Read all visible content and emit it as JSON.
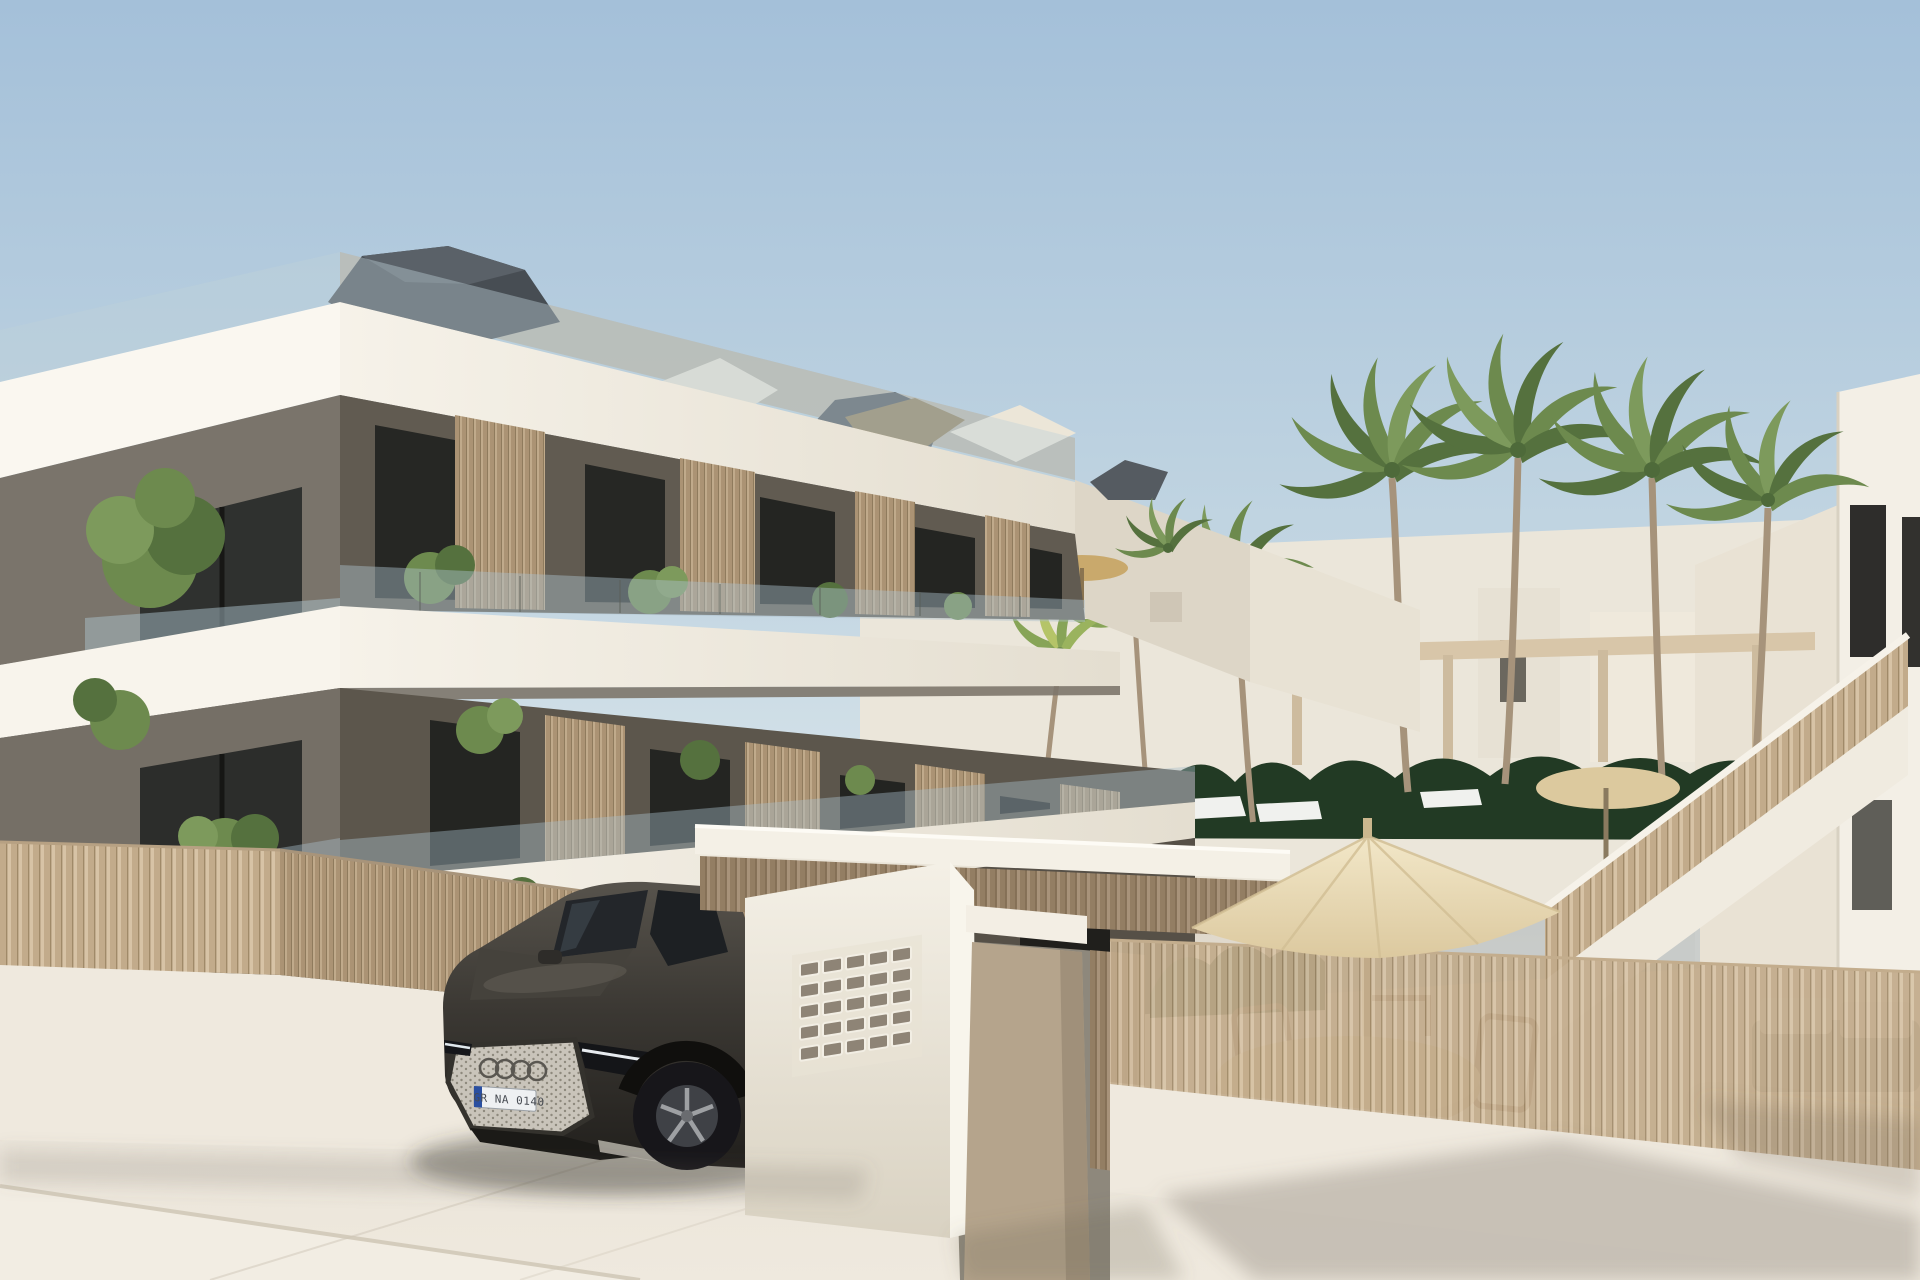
{
  "scene": {
    "title": "New-build apartment complex exterior render",
    "setting": "street-side daytime view with driveway, entrance gate, pool terrace and palm trees",
    "sky": "clear gradient sky"
  },
  "license_plate": {
    "text": "GR NA 0140",
    "eu_band": true
  },
  "palette": {
    "sky_top": "#a4c0d9",
    "sky_horizon": "#eef3f2",
    "fascia_white": "#f8f4ec",
    "fascia_shade": "#e7e1d4",
    "wall_taupe": "#7a746b",
    "wall_taupe_shadow": "#5f594f",
    "window_dark": "#2a2b28",
    "glass_balustrade": "#aabfca",
    "roof_dark": "#474d53",
    "slat_wood": "#c4ae8f",
    "slat_wood_dark": "#a8937a",
    "fence_wood": "#cdb89a",
    "foliage": "#6d8a4e",
    "foliage_dark": "#55713e",
    "hedge_dark": "#223a24",
    "palm_trunk": "#a6937b",
    "pavement": "#e9e3d8",
    "street_light": "#f2ede3",
    "umbrella_cream": "#ecdfbd",
    "pool_water": "#b7c2c6",
    "car_body": "#3b3833",
    "car_glass": "#1d2023",
    "grille_mesh": "#c9c4ba",
    "wheel_rim": "#9ea0a3",
    "plate_blue": "#2a4fa0"
  },
  "objects": [
    {
      "name": "apartment-building",
      "desc": "three-storey white and taupe block with stacked balconies"
    },
    {
      "name": "roof",
      "desc": "dark faceted hip roofs behind white fascia"
    },
    {
      "name": "balcony-privacy-screens",
      "desc": "vertical wooden slat dividers"
    },
    {
      "name": "glass-balustrades",
      "desc": "frameless glass balcony railings"
    },
    {
      "name": "balcony-plants",
      "desc": "green potted plants on terraces"
    },
    {
      "name": "perimeter-fence",
      "desc": "beige vertical slat fence on white base wall"
    },
    {
      "name": "entrance-gate",
      "desc": "white lintel beam, mailbox wall and beige pillar"
    },
    {
      "name": "mailbox-panel",
      "desc": "grid of letterbox slots on white wall"
    },
    {
      "name": "car",
      "desc": "dark grey Audi SUV parked in driveway"
    },
    {
      "name": "patio-umbrella",
      "desc": "large cream parasol over wooden dining set"
    },
    {
      "name": "outdoor-dining-set",
      "desc": "round rattan table with wooden chairs"
    },
    {
      "name": "outdoor-sofa",
      "desc": "grey garden sofa with light cushions"
    },
    {
      "name": "palm-trees",
      "desc": "tall palms around pool terrace"
    },
    {
      "name": "hedge",
      "desc": "dark green hedge behind pool fence"
    },
    {
      "name": "sun-loungers",
      "desc": "white loungers by the pool"
    },
    {
      "name": "pergola",
      "desc": "light timber pergola structure"
    },
    {
      "name": "staircase",
      "desc": "external stair with slatted railing to neighbour building"
    },
    {
      "name": "neighbour-building",
      "desc": "white building at right edge"
    },
    {
      "name": "street",
      "desc": "light stone paving with soft shadows"
    }
  ]
}
